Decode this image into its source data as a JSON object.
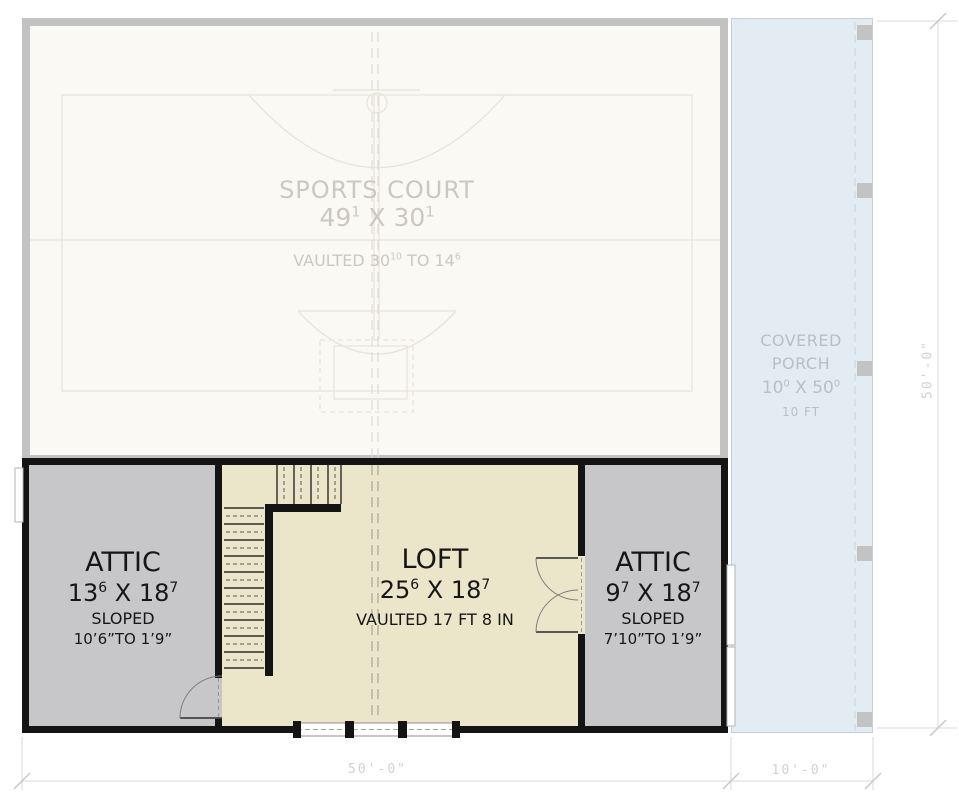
{
  "colors": {
    "wall_ghost_gray": "#c2c2c2",
    "wall_black": "#141414",
    "attic_gray": "#c7c6c8",
    "loft_cream": "#ebe6c9",
    "porch_blue": "#e3ecf2",
    "ghost_text": "#cbc8c0",
    "porch_text": "#b8bfc7",
    "dim_text": "#d3d1cd"
  },
  "court": {
    "title": "SPORTS COURT",
    "dim": {
      "pre": "49",
      "sup1": "1",
      "mid": " X 30",
      "sup2": "1"
    },
    "note": {
      "pre": "VAULTED 30",
      "sup1": "10",
      "mid": " TO 14",
      "sup2": "6"
    }
  },
  "porch": {
    "line1": "COVERED",
    "line2": "PORCH",
    "dim": {
      "pre": "10",
      "sup1": "0",
      "mid": " X 50",
      "sup2": "0"
    },
    "note": "10 FT"
  },
  "attic_left": {
    "title": "ATTIC",
    "dim": {
      "pre": "13",
      "sup1": "6",
      "mid": " X 18",
      "sup2": "7"
    },
    "note1": "SLOPED",
    "note2": "10’6”TO 1’9”"
  },
  "loft": {
    "title": "LOFT",
    "dim": {
      "pre": "25",
      "sup1": "6",
      "mid": " X 18",
      "sup2": "7"
    },
    "note": "VAULTED 17 FT 8 IN"
  },
  "attic_right": {
    "title": "ATTIC",
    "dim": {
      "pre": "9",
      "sup1": "7",
      "mid": " X 18",
      "sup2": "7"
    },
    "note1": "SLOPED",
    "note2": "7’10”TO 1’9”"
  },
  "dimensions": {
    "bottom_main": "50'-0\"",
    "bottom_porch": "10'-0\"",
    "right_side": "50'-0\""
  }
}
